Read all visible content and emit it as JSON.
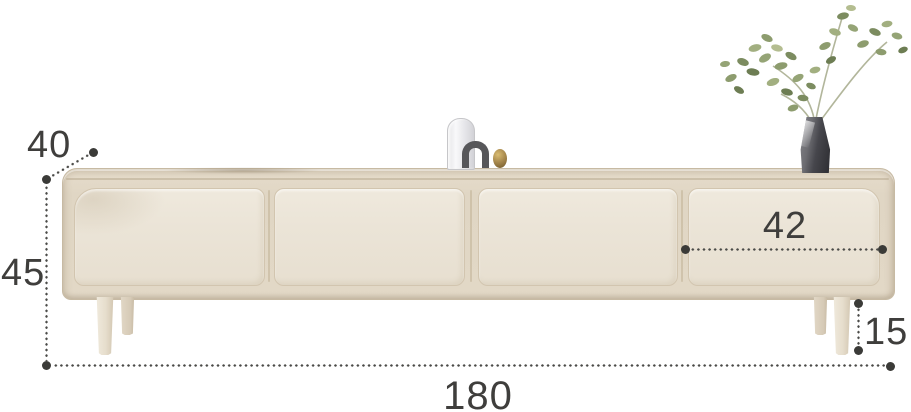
{
  "diagram": {
    "dimensions": {
      "depth": "40",
      "height": "45",
      "width": "180",
      "drawer_width": "42",
      "leg_height": "15"
    },
    "colors": {
      "background": "#ffffff",
      "cabinet_body": "#e0d6c4",
      "drawer_front": "#ebe4d7",
      "dimension_marks": "#3c3c3a",
      "leaf_green": "#879668",
      "vase_dark": "#3a3a3f",
      "brass_accent": "#a98a4e"
    }
  }
}
